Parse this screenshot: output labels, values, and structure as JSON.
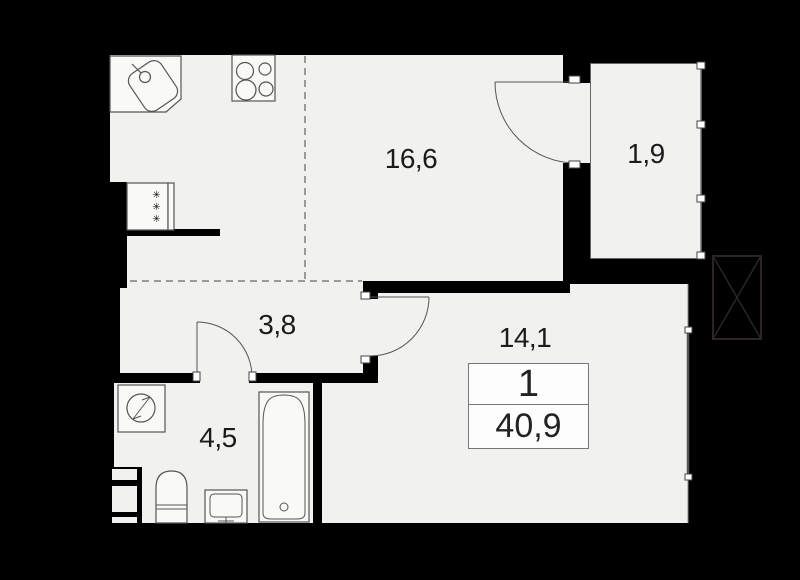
{
  "rooms": {
    "kitchen_living": {
      "label": "16,6"
    },
    "balcony": {
      "label": "1,9"
    },
    "hallway": {
      "label": "3,8"
    },
    "bedroom": {
      "label": "14,1"
    },
    "bathroom": {
      "label": "4,5"
    }
  },
  "summary": {
    "rooms_count": "1",
    "total_area": "40,9"
  },
  "fixtures": {
    "freezer_marks": "✳✳✳",
    "items": [
      "kitchen-sink",
      "cooktop",
      "refrigerator",
      "washing-machine",
      "toilet",
      "washbasin",
      "bathtub",
      "balcony-door",
      "bedroom-door",
      "bathroom-door",
      "ventilation-shaft",
      "balcony-glazing",
      "bedroom-window"
    ]
  },
  "colors": {
    "background": "#000000",
    "floor": "#f1f1ef",
    "fixture_fill": "#f9f9f8",
    "outline": "#555555",
    "dashed_line": "#9b9b9b",
    "label_text": "#1b1b1b",
    "shaft_line": "#2b2525"
  }
}
